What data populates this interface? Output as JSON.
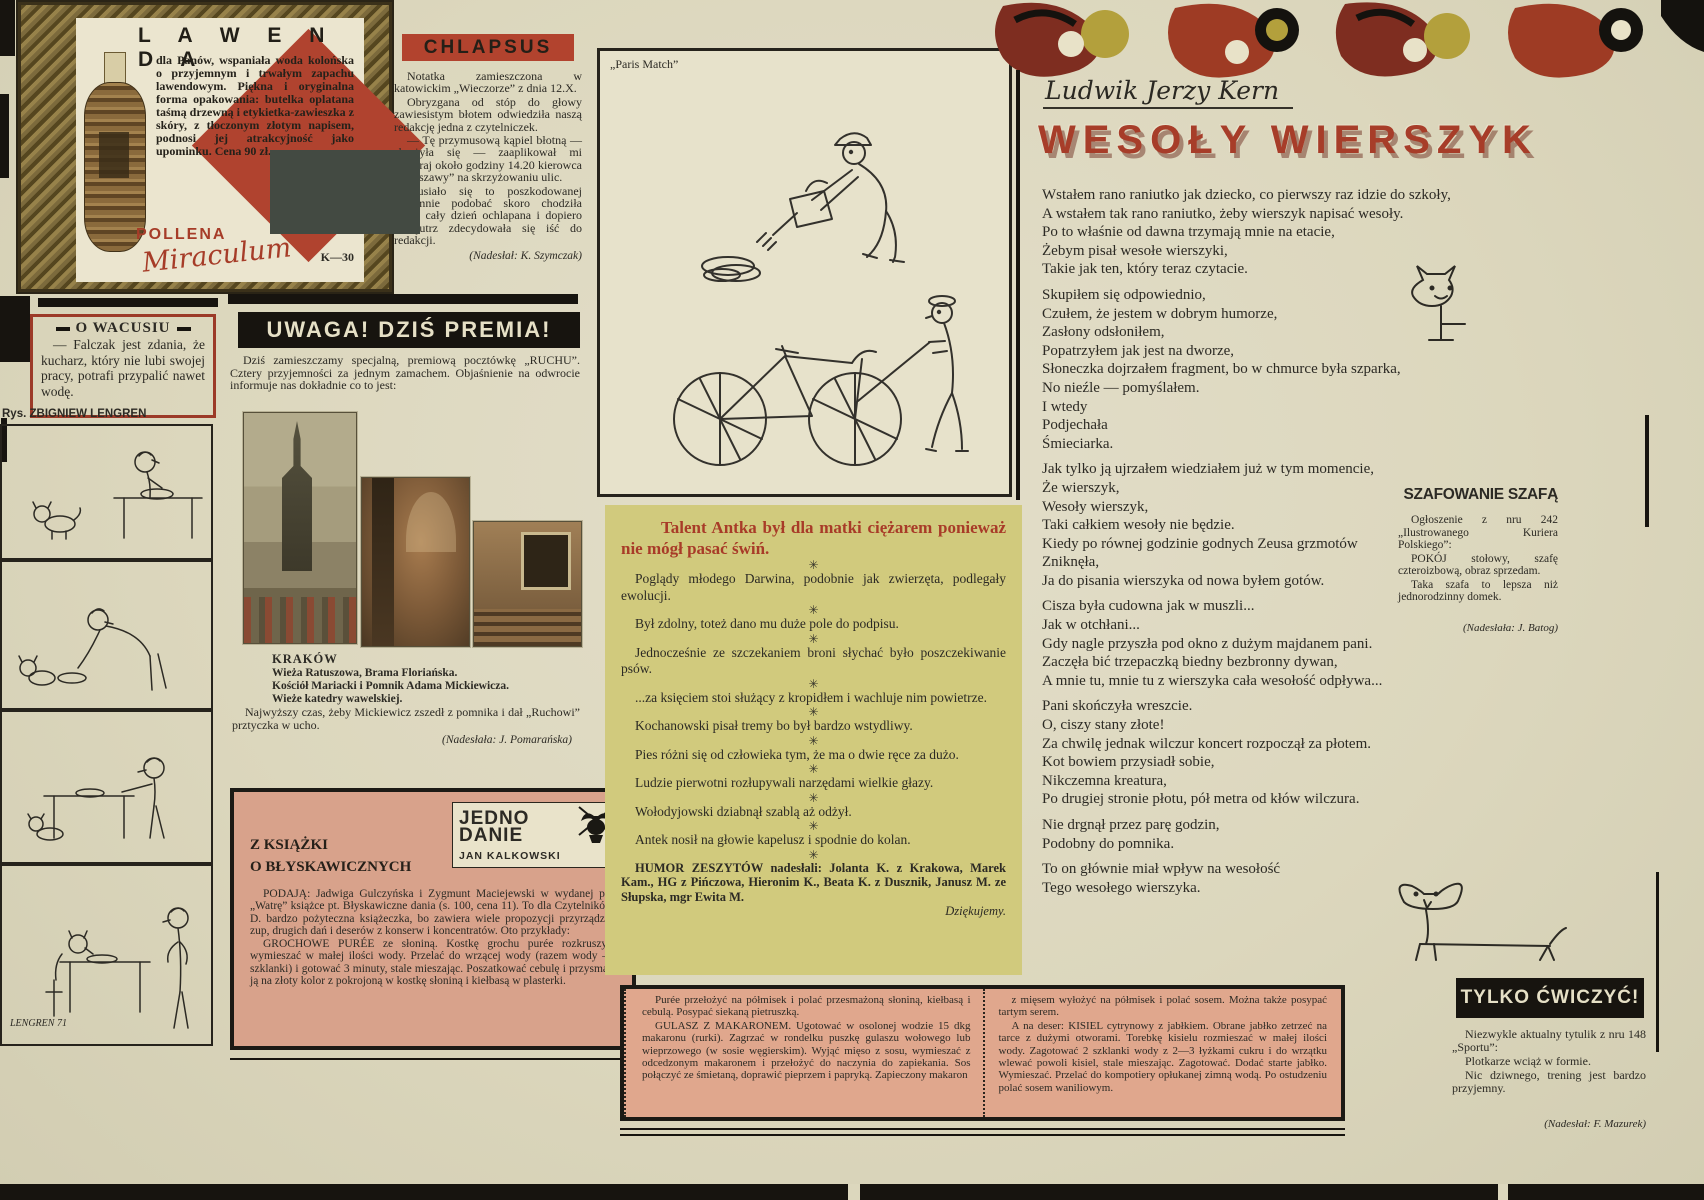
{
  "colors": {
    "paper": "#dcd7bd",
    "ink": "#2c2a24",
    "red": "#ab3d2a",
    "banner_red": "#b2432e",
    "black": "#17140f",
    "green_box": "#d1ca7d",
    "pink_box": "#d8a28b",
    "recipe_box": "#e0a78d",
    "cream": "#ebe5cf"
  },
  "lawenda": {
    "title": "L A W E N D A",
    "body": "dla Panów, wspaniała woda kolońska o przyjemnym i trwałym zapachu lawendowym. Piękna i oryginalna forma opakowania: butelka oplatana taśmą drzewną i etykietka-zawieszka z skóry, z tłoczonym złotym napisem, podnosi jej atrakcyjność jako upominku. Cena 90 zł.",
    "code": "K—30",
    "brand_line1": "POLLENA",
    "brand_line2": "Miraculum"
  },
  "o_wacusiu": {
    "title": "O WACUSIU",
    "body": "— Falczak jest zdania, że kucharz, który nie lubi swojej pracy, potrafi przypalić nawet wodę."
  },
  "lengren": {
    "credit": "Rys. ZBIGNIEW LENGREN",
    "signature": "LENGREN 71"
  },
  "chlapsus": {
    "title": "CHLAPSUS",
    "paragraphs": [
      "Notatka zamieszczona w katowickim „Wieczorze” z dnia 12.X.",
      "Obryzgana od stóp do głowy zawiesistym błotem odwiedziła naszą redakcję jedna z czytelniczek.",
      "— Tę przymusową kąpiel błotną — skarżyła się — zaaplikował mi wczoraj około godziny 14.20 kierowca „Warszawy” na skrzyżowaniu ulic.",
      "Musiało się to poszkodowanej ogromnie podobać skoro chodziła przez cały dzień ochlapana i dopiero nazajutrz zdecydowała się iść do redakcji."
    ],
    "credit": "(Nadesłał: K. Szymczak)"
  },
  "premia": {
    "title": "UWAGA! DZIŚ PREMIA!",
    "intro": "Dziś zamieszczamy specjalną, premiową pocztówkę „RUCHU”. Cztery przyjemności za jednym zamachem. Objaśnienie na odwrocie informuje nas dokładnie co to jest:",
    "city": "KRAKÓW",
    "caption_lines": [
      "Wieża Ratuszowa, Brama Floriańska.",
      "Kościół Mariacki i Pomnik Adama Mickiewicza.",
      "Wieże katedry wawelskiej."
    ],
    "note": "Najwyższy czas, żeby Mickiewicz zszedł z pomnika i dał „Ruchowi” prztyczka w ucho.",
    "credit": "(Nadesłała: J. Pomarańska)"
  },
  "jedno_danie": {
    "heading_line1": "Z KSIĄŻKI",
    "heading_line2": "O BŁYSKAWICZNYCH",
    "logo_line1": "JEDNO",
    "logo_line2": "DANIE",
    "logo_author": "JAN KALKOWSKI",
    "paragraphs": [
      "PODAJĄ: Jadwiga Gulczyńska i Zygmunt Maciejewski w wydanej przez „Watrę” książce pt. Błyskawiczne dania (s. 100, cena 11). To dla Czytelników J. D. bardzo pożyteczna książeczka, bo zawiera wiele propozycji przyrządzania zup, drugich dań i deserów z konserw i koncentratów. Oto przykłady:",
      "GROCHOWE PURÉE ze słoniną. Kostkę grochu purée rozkruszyć i wymieszać w małej ilości wody. Przelać do wrzącej wody (razem wody — 2 szklanki) i gotować 3 minuty, stale mieszając. Poszatkować cebulę i przysmażyć ją na złoty kolor z pokrojoną w kostkę słoniną i kiełbasą w plasterki."
    ]
  },
  "paris_match": {
    "label": "„Paris Match”"
  },
  "humor": {
    "title": "Talent Antka był dla matki ciężarem ponieważ nie mógł pasać świń.",
    "separator": "✳",
    "items": [
      "Poglądy młodego Darwina, podobnie jak zwierzęta, podlegały ewolucji.",
      "Był zdolny, toteż dano mu duże pole do podpisu.",
      "Jednocześnie ze szczekaniem broni słychać było poszczekiwanie psów.",
      "...za księciem stoi służący z kropidłem i wachluje nim powietrze.",
      "Kochanowski pisał tremy bo był bardzo wstydliwy.",
      "Pies różni się od człowieka tym, że ma o dwie ręce za dużo.",
      "Ludzie pierwotni rozłupywali narzędami wielkie głazy.",
      "Wołodyjowski dziabnął szablą aż odżył.",
      "Antek nosił na głowie kapelusz i spodnie do kolan."
    ],
    "credits": "HUMOR ZESZYTÓW nadesłali: Jolanta K. z Krakowa, Marek Kam., HG z Pińczowa, Hieronim K., Beata K. z Dusznik, Janusz M. ze Słupska, mgr Ewita M.",
    "thanks": "Dziękujemy."
  },
  "kern": {
    "author": "Ludwik Jerzy Kern",
    "title": "WESOŁY WIERSZYK",
    "stanzas": [
      [
        "Wstałem rano raniutko jak dziecko, co pierwszy raz idzie do szkoły,",
        "A wstałem tak rano raniutko, żeby wierszyk napisać wesoły.",
        "Po to właśnie od dawna trzymają mnie na etacie,",
        "Żebym pisał wesołe wierszyki,",
        "Takie jak ten, który teraz czytacie."
      ],
      [
        "Skupiłem się odpowiednio,",
        "Czułem, że jestem w dobrym humorze,",
        "Zasłony odsłoniłem,",
        "Popatrzyłem jak jest na dworze,",
        "Słoneczka dojrzałem fragment, bo w chmurce była szparka,",
        "No nieźle — pomyślałem.",
        "I wtedy",
        "Podjechała",
        "Śmieciarka."
      ],
      [
        "Jak tylko ją ujrzałem wiedziałem już w tym momencie,",
        "Że wierszyk,",
        "Wesoły wierszyk,",
        "Taki całkiem wesoły nie będzie.",
        "Kiedy po równej godzinie godnych Zeusa grzmotów",
        "Zniknęła,",
        "Ja do pisania wierszyka od nowa byłem gotów."
      ],
      [
        "Cisza była cudowna jak w muszli...",
        "Jak w otchłani...",
        "Gdy nagle przyszła pod okno z dużym majdanem pani.",
        "Zaczęła bić trzepaczką biedny bezbronny dywan,",
        "A mnie tu, mnie tu z wierszyka cała wesołość odpływa..."
      ],
      [
        "Pani skończyła wreszcie.",
        "O, ciszy stany złote!",
        "Za chwilę jednak wilczur koncert rozpoczął za płotem.",
        "Kot bowiem przysiadł sobie,",
        "Nikczemna kreatura,",
        "Po drugiej stronie płotu, pół metra od kłów wilczura."
      ],
      [
        "Nie drgnął przez parę godzin,",
        "Podobny do pomnika."
      ],
      [
        "To on głównie miał wpływ na wesołość",
        "Tego wesołego wierszyka."
      ]
    ]
  },
  "szafowanie": {
    "title": "SZAFOWANIE SZAFĄ",
    "paragraphs": [
      "Ogłoszenie z nru 242 „Ilustrowanego Kuriera Polskiego”:",
      "POKÓJ stołowy, szafę czteroizbową, obraz sprzedam.",
      "Taka szafa to lepsza niż jednorodzinny domek."
    ],
    "credit": "(Nadesłała: J. Batog)"
  },
  "recipes": {
    "left_paragraphs": [
      "Purée przełożyć na półmisek i polać przesmażoną słoniną, kiełbasą i cebulą. Posypać siekaną pietruszką.",
      "GULASZ Z MAKARONEM. Ugotować w osolonej wodzie 15 dkg makaronu (rurki). Zagrzać w rondelku puszkę gulaszu wołowego lub wieprzowego (w sosie węgierskim). Wyjąć mięso z sosu, wymieszać z odcedzonym makaronem i przełożyć do naczynia do zapiekania. Sos połączyć ze śmietaną, doprawić pieprzem i papryką. Zapieczony makaron"
    ],
    "right_paragraphs": [
      "z mięsem wyłożyć na półmisek i polać sosem. Można także posypać tartym serem.",
      "A na deser: KISIEL cytrynowy z jabłkiem. Obrane jabłko zetrzeć na tarce z dużymi otworami. Torebkę kisielu rozmieszać w małej ilości wody. Zagotować 2 szklanki wody z 2—3 łyżkami cukru i do wrzątku wlewać powoli kisiel, stale mieszając. Zagotować. Dodać starte jabłko. Wymieszać. Przelać do kompotiery opłukanej zimną wodą. Po ostudzeniu polać sosem waniliowym."
    ]
  },
  "cwiczyc": {
    "title": "TYLKO ĆWICZYĆ!",
    "paragraphs": [
      "Niezwykle aktualny tytulik z nru 148 „Sportu”:",
      "Plotkarze wciąż w formie.",
      "Nic dziwnego, trening jest bardzo przyjemny."
    ],
    "credit": "(Nadesłał: F. Mazurek)"
  }
}
